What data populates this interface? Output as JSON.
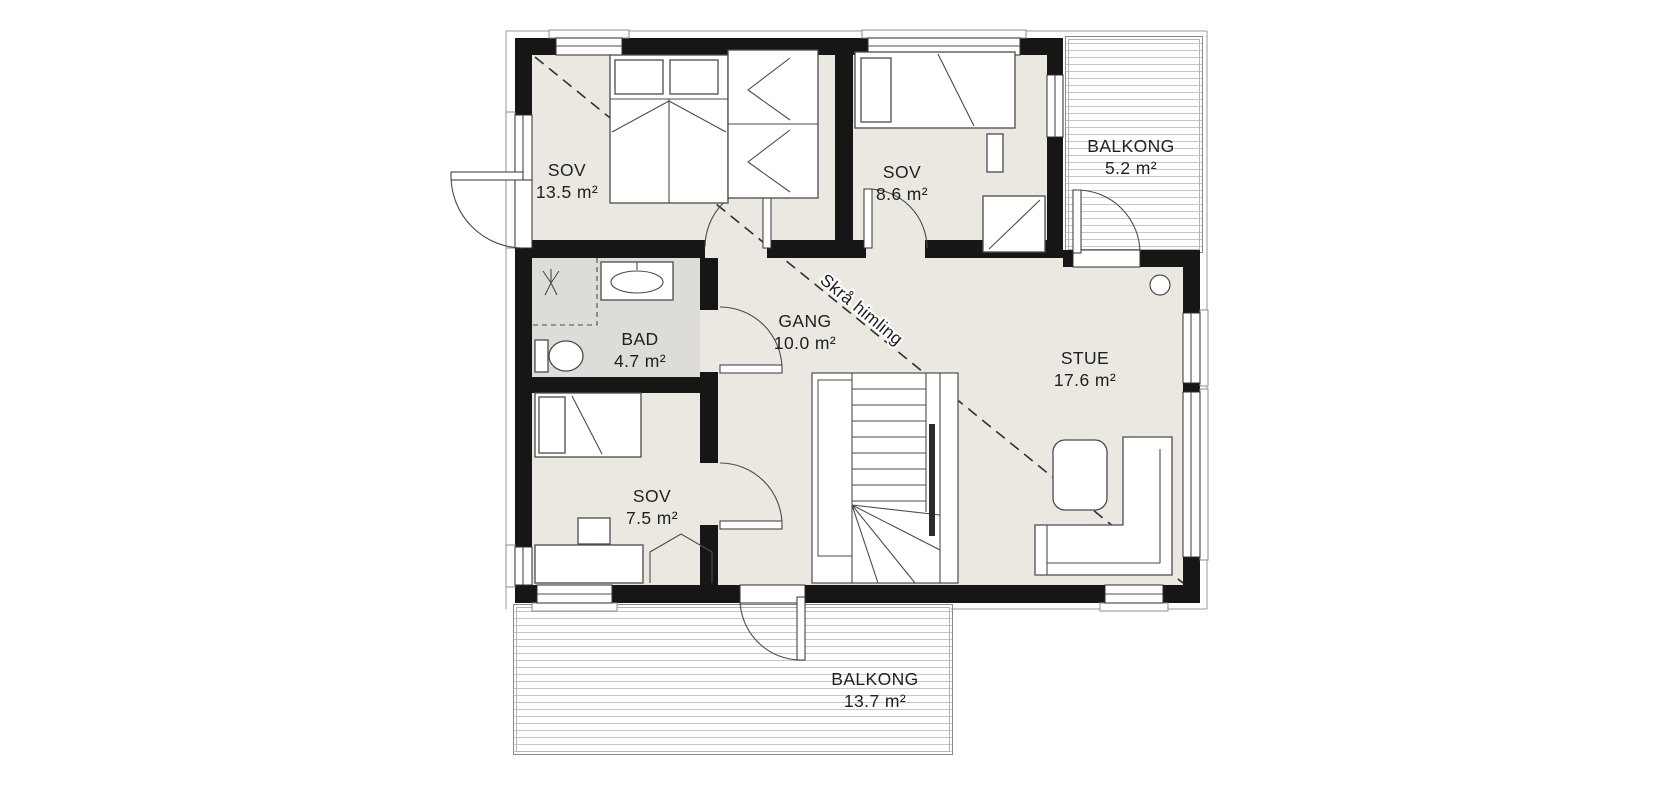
{
  "plan": {
    "type": "floor-plan",
    "rooms": [
      {
        "name": "SOV",
        "area": "13.5 m²"
      },
      {
        "name": "SOV",
        "area": "8.6 m²"
      },
      {
        "name": "BALKONG",
        "area": "5.2 m²"
      },
      {
        "name": "BAD",
        "area": "4.7 m²"
      },
      {
        "name": "GANG",
        "area": "10.0 m²"
      },
      {
        "name": "STUE",
        "area": "17.6 m²"
      },
      {
        "name": "SOV",
        "area": "7.5 m²"
      },
      {
        "name": "BALKONG",
        "area": "13.7 m²"
      }
    ],
    "annotations": {
      "sloped_ceiling": "Skrå himling"
    },
    "colors": {
      "wall": "#161616",
      "floor": "#eae8e0",
      "bathroom_floor": "#dddcd8",
      "deck_line": "#c6c6c6",
      "outline": "#9a9a9a",
      "furniture_line": "#4c4c4c",
      "text": "#1f1f1f"
    }
  }
}
